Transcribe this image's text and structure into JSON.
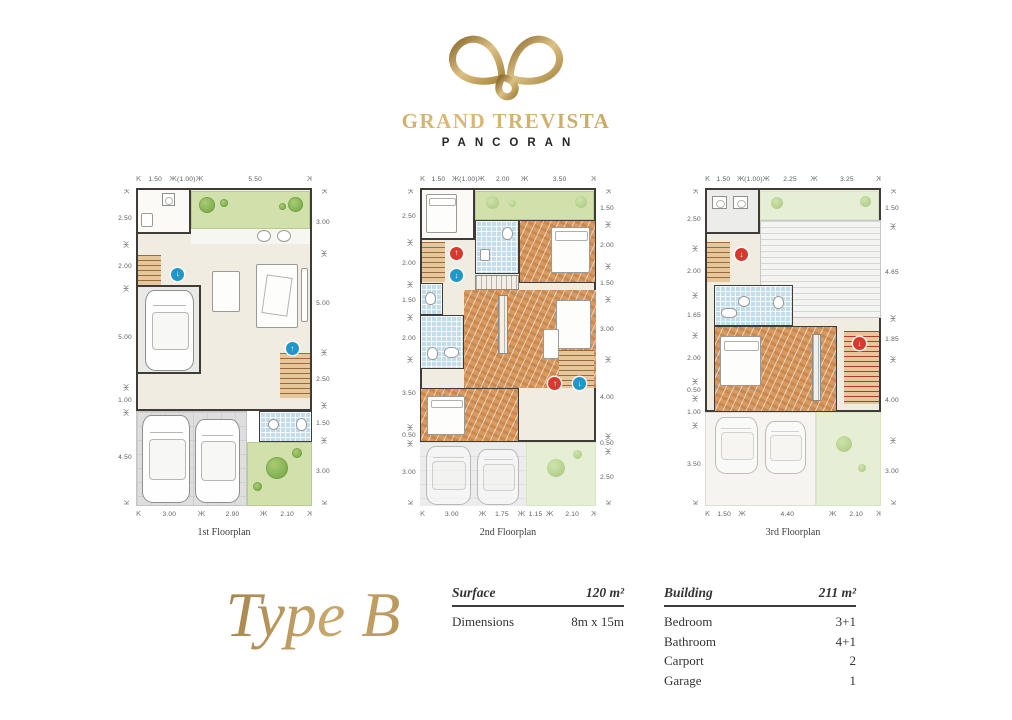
{
  "logo": {
    "icon": "butterfly-leaves-icon",
    "brand": "GRAND TREVISTA",
    "sub": "PANCORAN"
  },
  "type_title": "Type B",
  "specs": {
    "surface_label": "Surface",
    "surface_value": "120 m²",
    "dimensions_label": "Dimensions",
    "dimensions_value": "8m x 15m",
    "building_label": "Building",
    "building_value": "211 m²",
    "rows": [
      {
        "label": "Bedroom",
        "value": "3+1"
      },
      {
        "label": "Bathroom",
        "value": "4+1"
      },
      {
        "label": "Carport",
        "value": "2"
      },
      {
        "label": "Garage",
        "value": "1"
      }
    ]
  },
  "plans": [
    {
      "caption": "1st Floorplan",
      "dims": {
        "top": [
          "1.50",
          "(1.00)",
          "5.50"
        ],
        "left": [
          "2.50",
          "2.00",
          "5.00",
          "1.00",
          "4.50"
        ],
        "right": [
          "3.00",
          "5.00",
          "2.50",
          "1.50",
          "3.00"
        ],
        "bottom": [
          "3.00",
          "2.90",
          "2.10"
        ]
      }
    },
    {
      "caption": "2nd Floorplan",
      "dims": {
        "top": [
          "1.50",
          "(1.00)",
          "2.00",
          "3.50"
        ],
        "left": [
          "2.50",
          "2.00",
          "1.50",
          "2.00",
          "3.50",
          "0.50",
          "3.00"
        ],
        "right": [
          "1.50",
          "2.00",
          "1.50",
          "3.00",
          "4.00",
          "0.50",
          "2.50"
        ],
        "bottom": [
          "3.00",
          "1.75",
          "1.15",
          "2.10"
        ]
      }
    },
    {
      "caption": "3rd Floorplan",
      "dims": {
        "top": [
          "1.50",
          "(1.00)",
          "2.25",
          "3.25"
        ],
        "left": [
          "2.50",
          "2.00",
          "1.65",
          "2.00",
          "0.50",
          "1.00",
          "3.50"
        ],
        "right": [
          "1.50",
          "4.65",
          "1.85",
          "4.00",
          "3.00"
        ],
        "bottom": [
          "1.50",
          "4.40",
          "2.10"
        ]
      }
    }
  ],
  "colors": {
    "gold": "#b9975b",
    "wall": "#3f3b37",
    "wood_floor": "#d79a62",
    "bath_tile": "#c2dce9",
    "garden_green": "#d2e0ab",
    "marker_red": "#d63a2f",
    "marker_blue": "#2096c9"
  }
}
